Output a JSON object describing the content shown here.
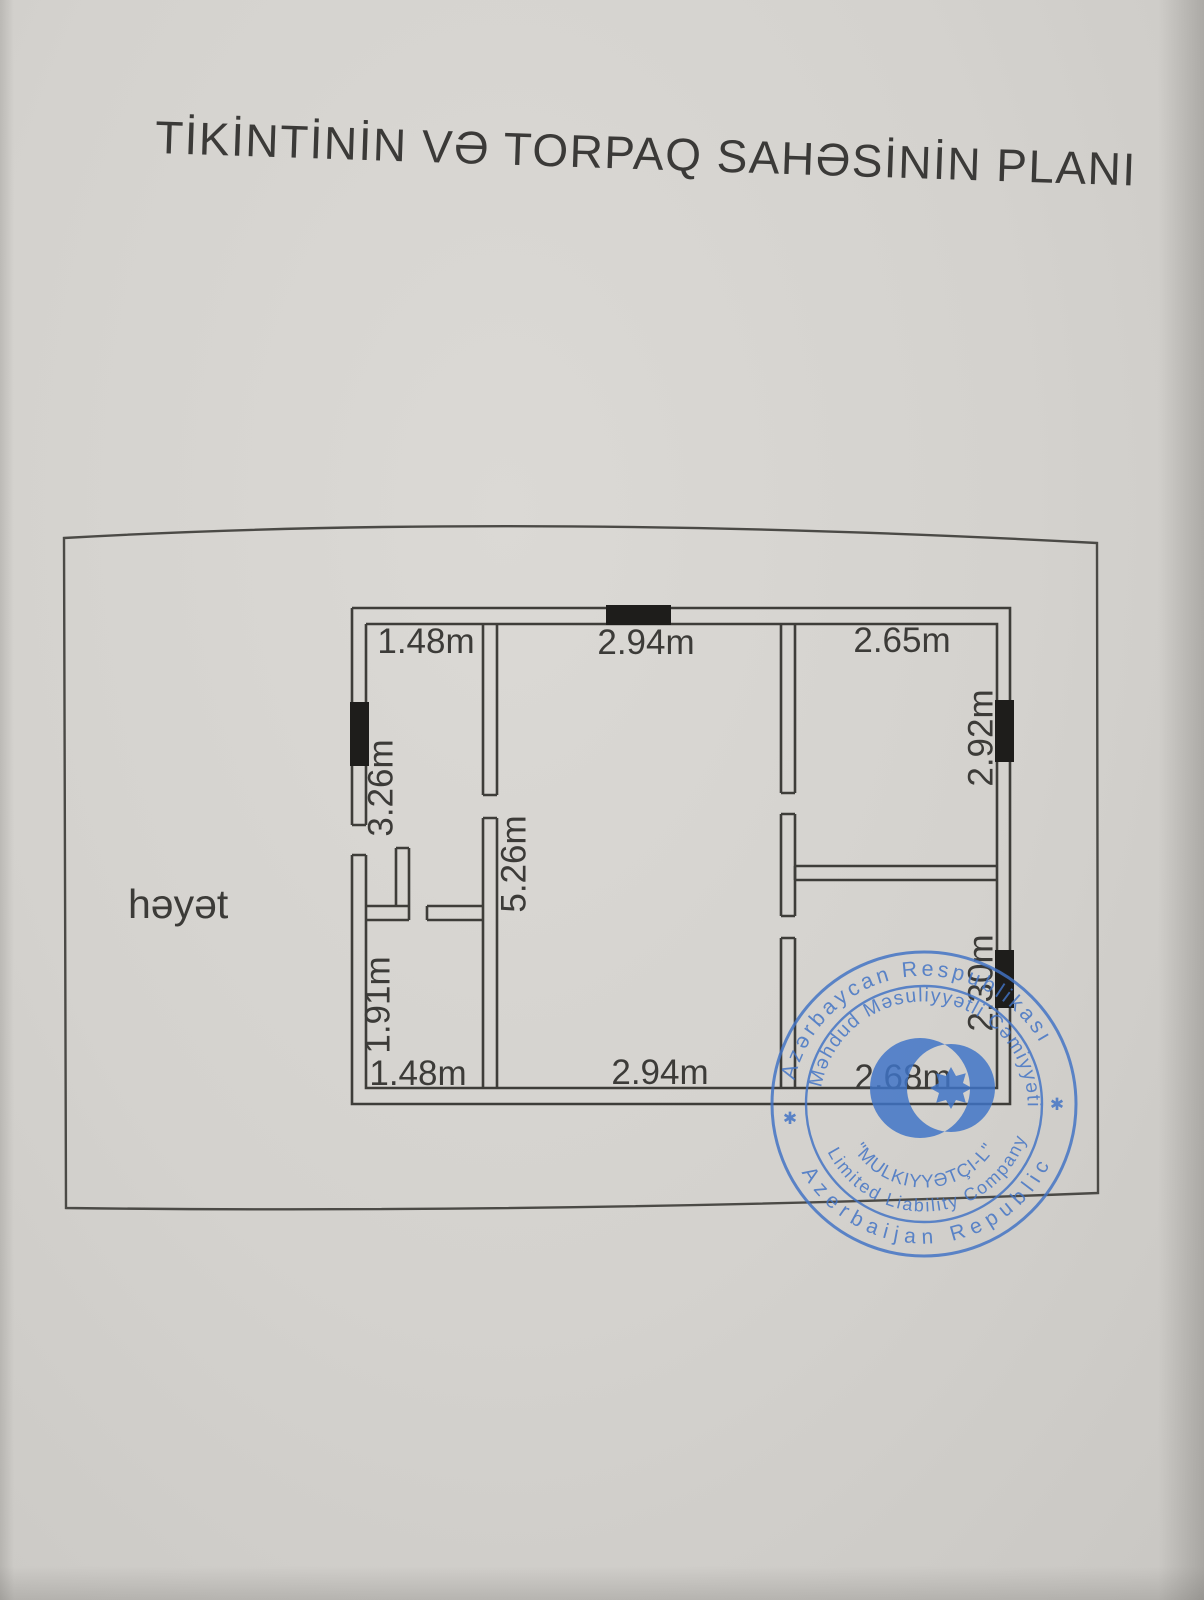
{
  "title": {
    "text": "TİKİNTİNİN VƏ TORPAQ SAHƏSİNİN PLANI"
  },
  "yard": {
    "label": "həyət"
  },
  "dims": {
    "top_left": "1.48m",
    "top_center": "2.94m",
    "top_right": "2.65m",
    "left_upper": "3.26m",
    "center": "5.26m",
    "left_lower": "1.91m",
    "right_upper": "2.92m",
    "right_lower": "2.30m",
    "bottom_left": "1.48m",
    "bottom_center": "2.94m",
    "bottom_right": "2.68m"
  },
  "stamp": {
    "ring_top": "Azərbaycan Respublikası",
    "ring_bottom": "Azerbaijan Republic",
    "inner_top": "Məhdud Məsuliyyətli Cəmiyyəti",
    "company_type_en": "Limited Liability Company",
    "company_name": "\"MULKIYYƏTÇI-L\"",
    "star": "✱",
    "ink_color": "#4173c5"
  },
  "colors": {
    "paper": "#d4d2ce",
    "plan_line": "#403f3b",
    "window_fill": "#1e1d1b",
    "stamp_blue": "#4173c5"
  }
}
